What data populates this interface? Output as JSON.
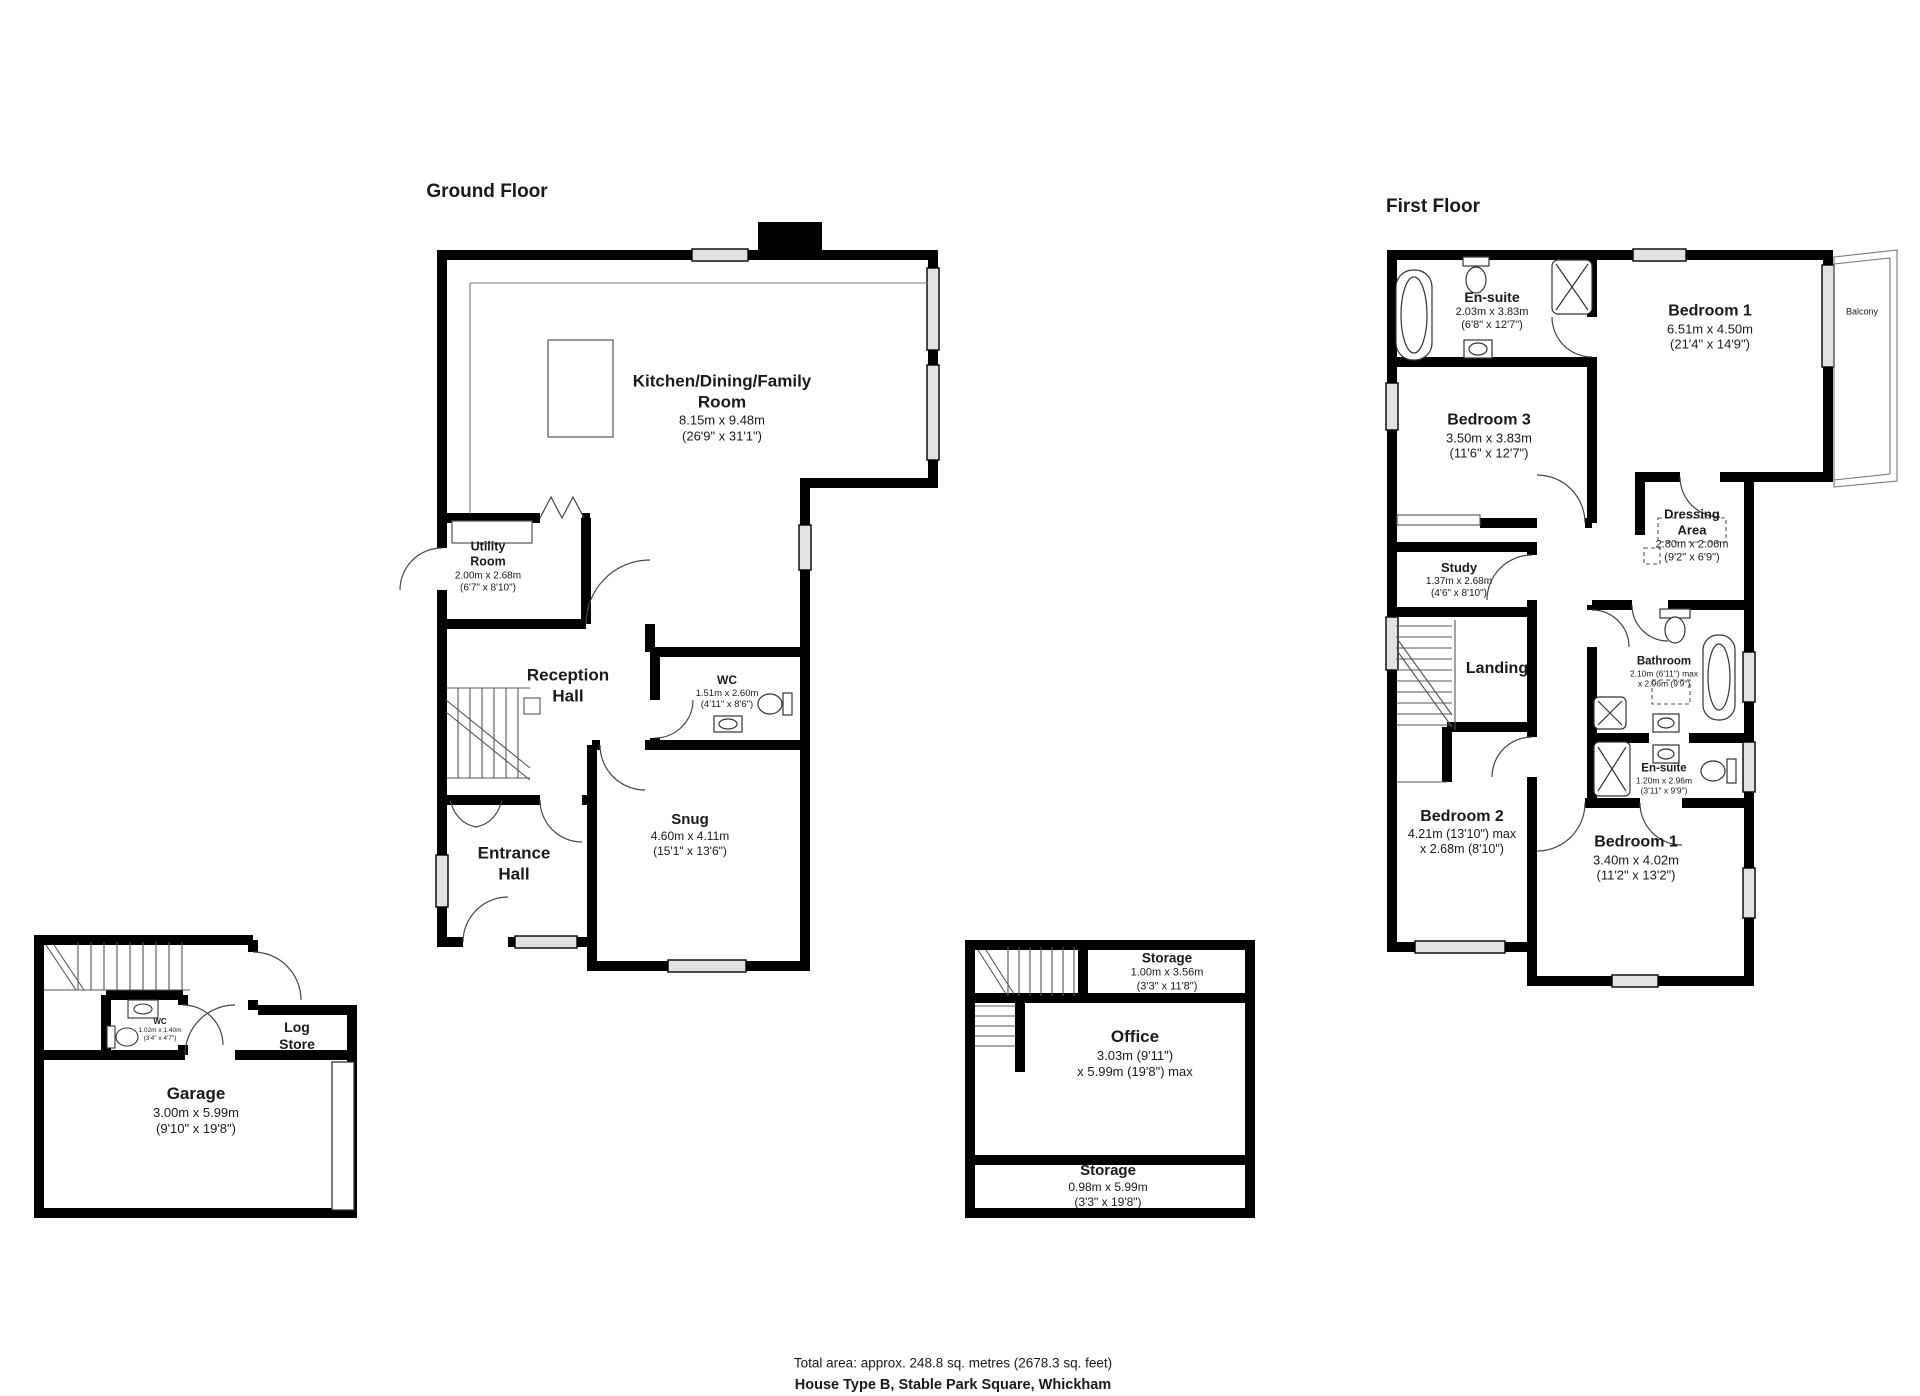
{
  "colors": {
    "wall": "#000000",
    "window_fill": "#e2e2e2",
    "thin_line": "#3a3a3a"
  },
  "footer": {
    "line1": "Total area: approx. 248.8 sq. metres (2678.3 sq. feet)",
    "line2": "House Type B, Stable Park Square, Whickham"
  },
  "ground": {
    "title": "Ground Floor",
    "kitchen": {
      "name": "Kitchen/Dining/Family",
      "name2": "Room",
      "d1": "8.15m x 9.48m",
      "d2": "(26'9\" x 31'1\")"
    },
    "utility": {
      "name": "Utility",
      "name2": "Room",
      "d1": "2.00m x 2.68m",
      "d2": "(6'7\" x 8'10\")"
    },
    "reception": {
      "name": "Reception",
      "name2": "Hall"
    },
    "wc": {
      "name": "WC",
      "d1": "1.51m x 2.60m",
      "d2": "(4'11\" x 8'6\")"
    },
    "snug": {
      "name": "Snug",
      "d1": "4.60m x 4.11m",
      "d2": "(15'1\" x 13'6\")"
    },
    "entrance": {
      "name": "Entrance",
      "name2": "Hall"
    }
  },
  "garage_block": {
    "garage": {
      "name": "Garage",
      "d1": "3.00m x 5.99m",
      "d2": "(9'10\" x 19'8\")"
    },
    "log_store": {
      "name": "Log",
      "name2": "Store"
    },
    "wc": {
      "name": "WC",
      "d1": "1.02m x 1.40m",
      "d2": "(3'4\" x 4'7\")"
    }
  },
  "office_block": {
    "storage_top": {
      "name": "Storage",
      "d1": "1.00m x 3.56m",
      "d2": "(3'3\" x 11'8\")"
    },
    "office": {
      "name": "Office",
      "d1": "3.03m (9'11\")",
      "d2": "x 5.99m (19'8\") max"
    },
    "storage_bottom": {
      "name": "Storage",
      "d1": "0.98m x 5.99m",
      "d2": "(3'3\" x 19'8\")"
    }
  },
  "first": {
    "title": "First Floor",
    "ensuite_top": {
      "name": "En-suite",
      "d1": "2.03m x 3.83m",
      "d2": "(6'8\" x 12'7\")"
    },
    "bedroom1_top": {
      "name": "Bedroom 1",
      "d1": "6.51m x 4.50m",
      "d2": "(21'4\" x 14'9\")"
    },
    "balcony": {
      "name": "Balcony"
    },
    "bedroom3": {
      "name": "Bedroom 3",
      "d1": "3.50m x 3.83m",
      "d2": "(11'6\" x 12'7\")"
    },
    "dressing": {
      "name": "Dressing",
      "name2": "Area",
      "d1": "2.80m x 2.06m",
      "d2": "(9'2\" x 6'9\")"
    },
    "study": {
      "name": "Study",
      "d1": "1.37m x 2.68m",
      "d2": "(4'6\" x 8'10\")"
    },
    "landing": {
      "name": "Landing"
    },
    "bathroom": {
      "name": "Bathroom",
      "d1": "2.10m (6'11\") max",
      "d2": "x 2.96m (9'9\")"
    },
    "ensuite_mid": {
      "name": "En-suite",
      "d1": "1.20m x 2.96m",
      "d2": "(3'11\" x 9'9\")"
    },
    "bedroom2": {
      "name": "Bedroom 2",
      "d1": "4.21m (13'10\") max",
      "d2": "x 2.68m (8'10\")"
    },
    "bedroom1_bottom": {
      "name": "Bedroom 1",
      "d1": "3.40m x 4.02m",
      "d2": "(11'2\" x 13'2\")"
    }
  }
}
